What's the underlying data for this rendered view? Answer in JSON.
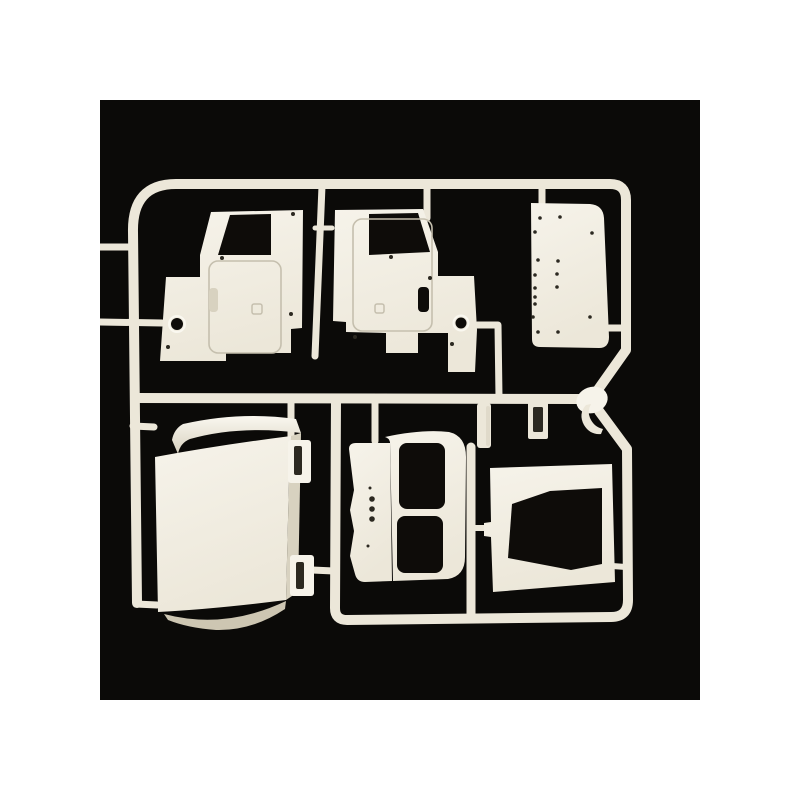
{
  "scene": {
    "type": "product-photo",
    "description": "White polystyrene model kit sprue (parts tree) with truck cab body panels, photographed on a black background",
    "colors": {
      "page_background": "#ffffff",
      "photo_background": "#0b0a08",
      "plastic": "#ece7d9",
      "plastic_bright": "#f6f3ea",
      "plastic_shadow": "#d8d2c0",
      "plastic_deep_shadow": "#cdc6b2",
      "opening_dark": "#0e0c09",
      "engraved_line": "#c5bfae",
      "detail_dot": "#2c2921",
      "highlight_ring": "#faf8f0"
    },
    "parts": [
      {
        "id": "cab-side-panel-left",
        "label": "Truck cab side panel, left, with door window opening"
      },
      {
        "id": "cab-side-panel-right",
        "label": "Truck cab side panel, right, with door window opening and fuel filler hole"
      },
      {
        "id": "cab-back-panel",
        "label": "Flat cab back panel with rivet and hole detail"
      },
      {
        "id": "sprue-knob-and-hook",
        "label": "Runner junction knob with small hook-shaped part"
      },
      {
        "id": "cab-roof-panel",
        "label": "Large curved cab roof/back panel with two slotted mounting brackets"
      },
      {
        "id": "door-sill-strip",
        "label": "Sill strip with three locating holes"
      },
      {
        "id": "rear-window-frame",
        "label": "Rear panel frame with two rectangular window openings"
      },
      {
        "id": "windshield-frame",
        "label": "Frame panel with trapezoidal window opening"
      },
      {
        "id": "small-clip-parts",
        "label": "Small clip and bracket pieces on center runners"
      }
    ]
  }
}
